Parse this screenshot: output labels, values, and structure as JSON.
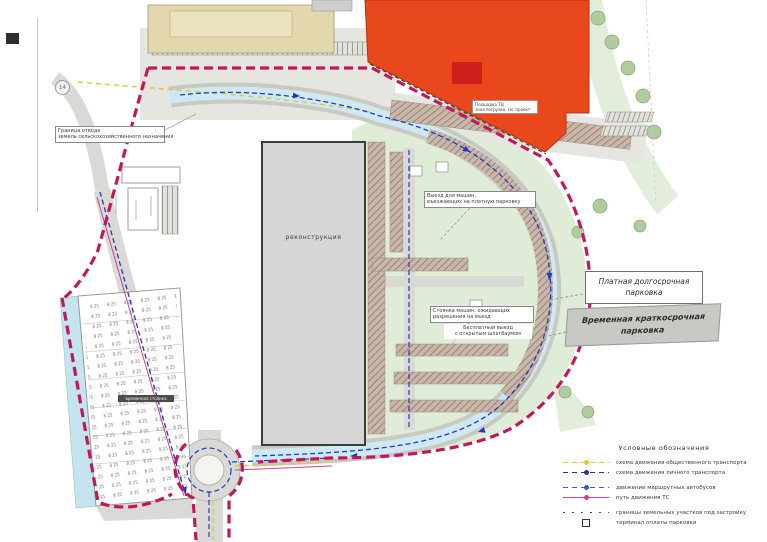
{
  "labels": {
    "central_building": "реконструкция",
    "boundary_note": {
      "line1": "Граница отвода",
      "line2": "земель сельскохозяйственного назначения"
    },
    "exit_note": {
      "line1": "Выезд для машин,",
      "line2": "въезжающих на платную парковку"
    },
    "waiting_note": {
      "line1": "Стоянка машин, ожидающих",
      "line2": "разрешения на въезд",
      "line3": "Бесплатный выезд",
      "line4": "с открытым шлагбаумом"
    },
    "red_building_note": {
      "line1": "Площадка ТЦ",
      "line2": "зона погрузки, см. проект"
    },
    "paid_parking": {
      "line1": "Платная долгосрочная",
      "line2": "парковка"
    },
    "temp_parking": {
      "line1": "Временная краткосрочная",
      "line2": "парковка"
    },
    "small_dark_label": "временная стоянка",
    "circle_marker": "14"
  },
  "legend": {
    "title": "Условные обозначения",
    "items": [
      {
        "label": "схема движения общественного транспорта",
        "color": "#ddc83e",
        "style": "dash withdot"
      },
      {
        "label": "схема движения личного транспорта",
        "color": "#27339b",
        "style": "dash withdot"
      },
      {
        "label": "движение маршрутных автобусов",
        "color": "#3a57c9",
        "style": "dash withdot"
      },
      {
        "label": "путь движения ТС",
        "color": "#d2418f",
        "style": "withdot"
      },
      {
        "label": "границы земельных участков под застройку",
        "color": "#4a4a4a",
        "style": "dotted"
      },
      {
        "label": "терминал оплаты парковки",
        "color": "#333333",
        "style": "square"
      }
    ]
  },
  "colors": {
    "red_building": "#e8481c",
    "red_inner": "#cf1f1f",
    "gray_building": "#d6d6d6",
    "tan_building": "#e3d7ad",
    "green_area": "#dfecd8",
    "road": "#d9d9d5",
    "cyan_road": "#cfe9f2",
    "boundary": "#c2185b",
    "route_blue": "#2438c4",
    "route_yellow": "#ddc83e",
    "route_magenta": "#d2418f",
    "hatch_parking": "#c9b8a9"
  }
}
